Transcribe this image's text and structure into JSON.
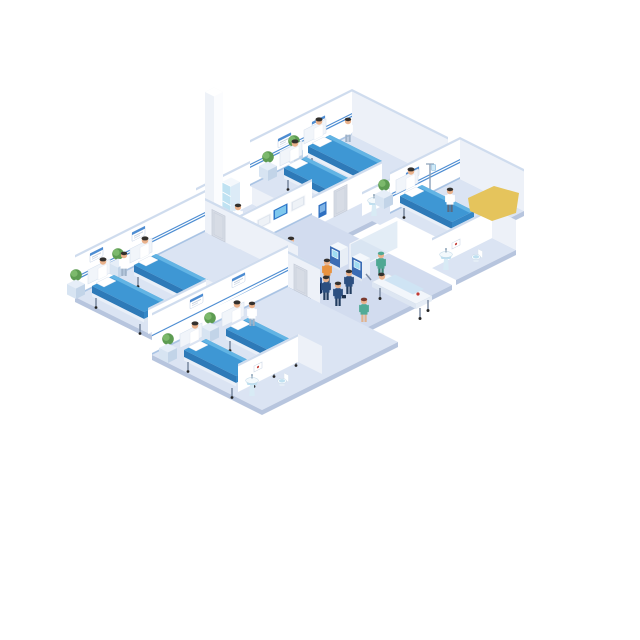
{
  "scene": {
    "type": "isometric-illustration",
    "subject": "Hospital ward floor cutaway: patient rooms with beds, bathrooms, reception desk, check-in kiosks, corridor with staff, patients and a gurney",
    "rooms": [
      {
        "id": "ward-room-top",
        "beds": 2,
        "patients_in_bed": 2,
        "staff": [
          "nurse"
        ],
        "furniture": [
          "hospital-bed",
          "hospital-bed",
          "bedside-cabinet",
          "potted-plant",
          "potted-plant",
          "wall-rail",
          "bed-sign",
          "bed-sign"
        ]
      },
      {
        "id": "ward-room-right",
        "beds": 1,
        "patients_in_bed": 1,
        "staff": [
          "doctor"
        ],
        "equipment": [
          "iv-drip-stand"
        ],
        "furniture": [
          "hospital-bed",
          "bedside-cabinet",
          "potted-plant",
          "wall-rail",
          "bed-sign"
        ]
      },
      {
        "id": "ward-room-left",
        "beds": 2,
        "patients_in_bed": 2,
        "staff": [
          "nurse"
        ],
        "furniture": [
          "hospital-bed",
          "hospital-bed",
          "bedside-cabinet",
          "potted-plant",
          "potted-plant",
          "wall-rail",
          "bed-sign",
          "bed-sign"
        ]
      },
      {
        "id": "ward-room-bottom",
        "beds": 2,
        "patients_in_bed": 2,
        "staff": [
          "nurse"
        ],
        "furniture": [
          "hospital-bed",
          "hospital-bed",
          "bedside-cabinet",
          "potted-plant",
          "potted-plant",
          "wall-rail",
          "bed-sign",
          "bed-sign"
        ]
      },
      {
        "id": "bathroom-top",
        "fixtures": [
          "pedestal-sink",
          "wall-picture"
        ]
      },
      {
        "id": "bathroom-right",
        "fixtures": [
          "pedestal-sink",
          "toilet",
          "wall-picture"
        ]
      },
      {
        "id": "bathroom-left",
        "fixtures": [
          "pedestal-sink",
          "toilet",
          "wall-picture"
        ]
      },
      {
        "id": "bathroom-bottom",
        "fixtures": [
          "pedestal-sink",
          "toilet",
          "wall-picture"
        ]
      },
      {
        "id": "utility-room",
        "furniture": [
          "medicine-cabinet",
          "tall-column"
        ],
        "staff": [
          "staff-member"
        ]
      }
    ],
    "reception": {
      "desk": "U-shaped navy counter",
      "sign": "illegible white lettering on blue band",
      "staff": [
        "receptionist"
      ],
      "items": [
        "desk-monitor",
        "blue-desk-item"
      ]
    },
    "corridor": {
      "kiosk_count": 2,
      "people": [
        "visitor-orange-shirt",
        "visitor-navy",
        "nurse-green-scrubs",
        "orderly-green-scrubs",
        "patient-on-gurney",
        "walker-navy-1",
        "walker-navy-2"
      ],
      "equipment": [
        "x-ray-viewer-wall",
        "glass-partition",
        "stretcher-gurney"
      ],
      "doors": 3,
      "posters": 1
    },
    "totals": {
      "beds": 7,
      "people": 17,
      "plants": 7
    },
    "decor": [
      "yellow-highlight-blob"
    ]
  },
  "palette": {
    "background": "#ffffff",
    "floor_room": "#dbe4f3",
    "floor_corridor": "#d2dcef",
    "floor_edge": "#b7c5de",
    "wall_white": "#ffffff",
    "wall_shade": "#edf1f8",
    "wall_cap": "#cfdcee",
    "rail_blue": "#4c8cd2",
    "bed_blanket": "#3e97d4",
    "bed_blanket_light": "#62b4e4",
    "bed_blanket_dark": "#2e7ab8",
    "bed_foot": "#3587c6",
    "bed_frame": "#e9eff8",
    "metal": "#7d8ca3",
    "skin": "#eab28c",
    "hair_dark": "#33302d",
    "scrub_green": "#4fa893",
    "navy_uniform": "#2c4f80",
    "shirt_orange": "#e8923f",
    "desk_navy": "#16386f",
    "desk_navy_dark": "#102b57",
    "desk_band": "#3f6cb5",
    "desk_top": "#2b57a0",
    "screen_blue": "#2e77c8",
    "screen_light": "#7fc8ee",
    "kiosk_blue": "#3a6cb4",
    "kiosk_screen": "#9fdcf2",
    "plant_green": "#5d9c52",
    "plant_green_light": "#7cb96c",
    "cabinet_blue": "#d7e4f2",
    "cabinet_blue_dark": "#c2d4e8",
    "glass_blue": "#bfe2f2",
    "fixture_blue": "#bfe0f0",
    "picture_red": "#c23b35",
    "poster_blue": "#2e6fc0",
    "door_gray": "#d7dce5",
    "accent_yellow": "#e5c45c",
    "gurney_white": "#f2f6fb"
  }
}
